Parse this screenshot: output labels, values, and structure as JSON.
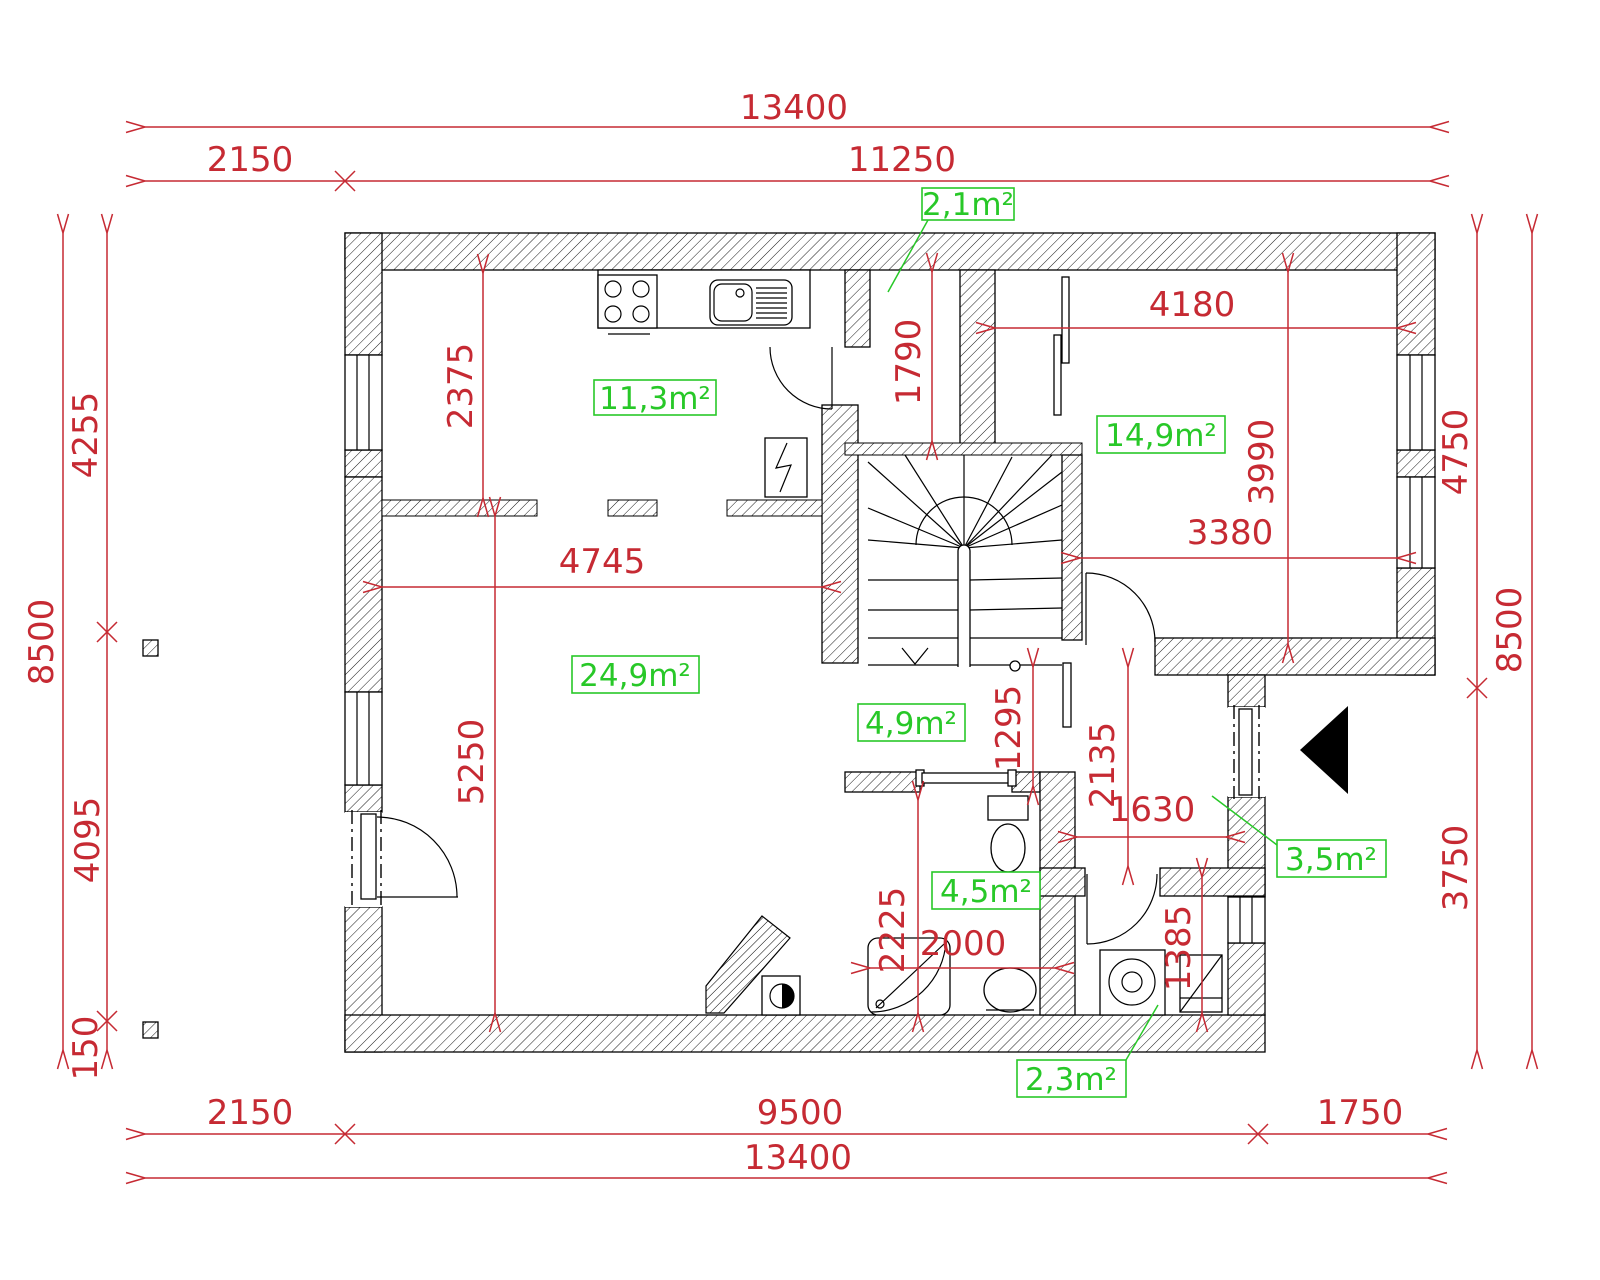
{
  "drawing_type": "floor-plan",
  "colors": {
    "dimension_red": "#c62a33",
    "area_green": "#28c828",
    "line_black": "#000000",
    "background": "#ffffff"
  },
  "dimensions": {
    "top": {
      "total": "13400",
      "seg_left": "2150",
      "seg_right": "11250"
    },
    "bottom": {
      "seg_left": "2150",
      "seg_mid": "9500",
      "seg_right": "1750",
      "total": "13400"
    },
    "left": {
      "total": "8500",
      "seg_upper": "4255",
      "seg_mid": "4095",
      "seg_lower": "150"
    },
    "right": {
      "total": "8500",
      "seg_upper": "4750",
      "seg_lower": "3750"
    },
    "interior": {
      "kitchen_depth": "2375",
      "entry_hall_length": "1790",
      "bedroom_width_top": "4180",
      "bedroom_height": "3990",
      "bedroom_width_bottom": "3380",
      "living_width": "4745",
      "living_height": "5250",
      "wc_hall_height": "1295",
      "corridor_height": "2135",
      "corridor_width": "1630",
      "bath_height": "2225",
      "bath_width": "2000",
      "utility_height": "1385"
    }
  },
  "rooms": {
    "entry_hall": "2,1m²",
    "kitchen": "11,3m²",
    "bedroom": "14,9m²",
    "living": "24,9m²",
    "wc_hall": "4,9m²",
    "bath": "4,5m²",
    "corridor": "3,5m²",
    "utility": "2,3m²"
  }
}
